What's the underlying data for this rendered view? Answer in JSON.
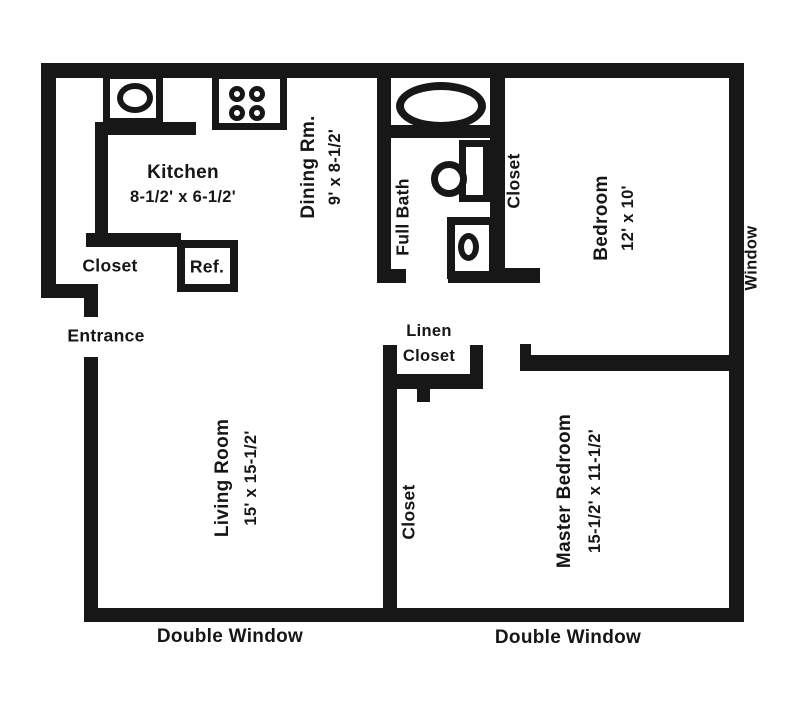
{
  "colors": {
    "ink": "#171717",
    "paper": "#ffffff"
  },
  "rooms": {
    "kitchen": {
      "name": "Kitchen",
      "dims": "8-1/2' x 6-1/2'"
    },
    "dining": {
      "name": "Dining Rm.",
      "dims": "9' x 8-1/2'"
    },
    "full_bath": {
      "name": "Full Bath"
    },
    "bath_closet": {
      "name": "Closet"
    },
    "bedroom": {
      "name": "Bedroom",
      "dims": "12' x 10'"
    },
    "living_room": {
      "name": "Living Room",
      "dims": "15' x 15-1/2'"
    },
    "master_bedroom": {
      "name": "Master Bedroom",
      "dims": "15-1/2' x 11-1/2'"
    },
    "entry_closet": {
      "name": "Closet"
    },
    "master_closet": {
      "name": "Closet"
    },
    "linen_closet": {
      "name_line1": "Linen",
      "name_line2": "Closet"
    }
  },
  "labels": {
    "entrance": "Entrance",
    "refrigerator": "Ref.",
    "window": "Window",
    "double_window_left": "Double Window",
    "double_window_right": "Double Window"
  },
  "fixtures": {
    "kitchen_sink": "oval-sink-in-counter",
    "stove": "four-burner-cooktop",
    "bathtub": "oval-tub",
    "bath_sink": "round-sink-on-counter",
    "toilet": "toilet-with-tank"
  }
}
